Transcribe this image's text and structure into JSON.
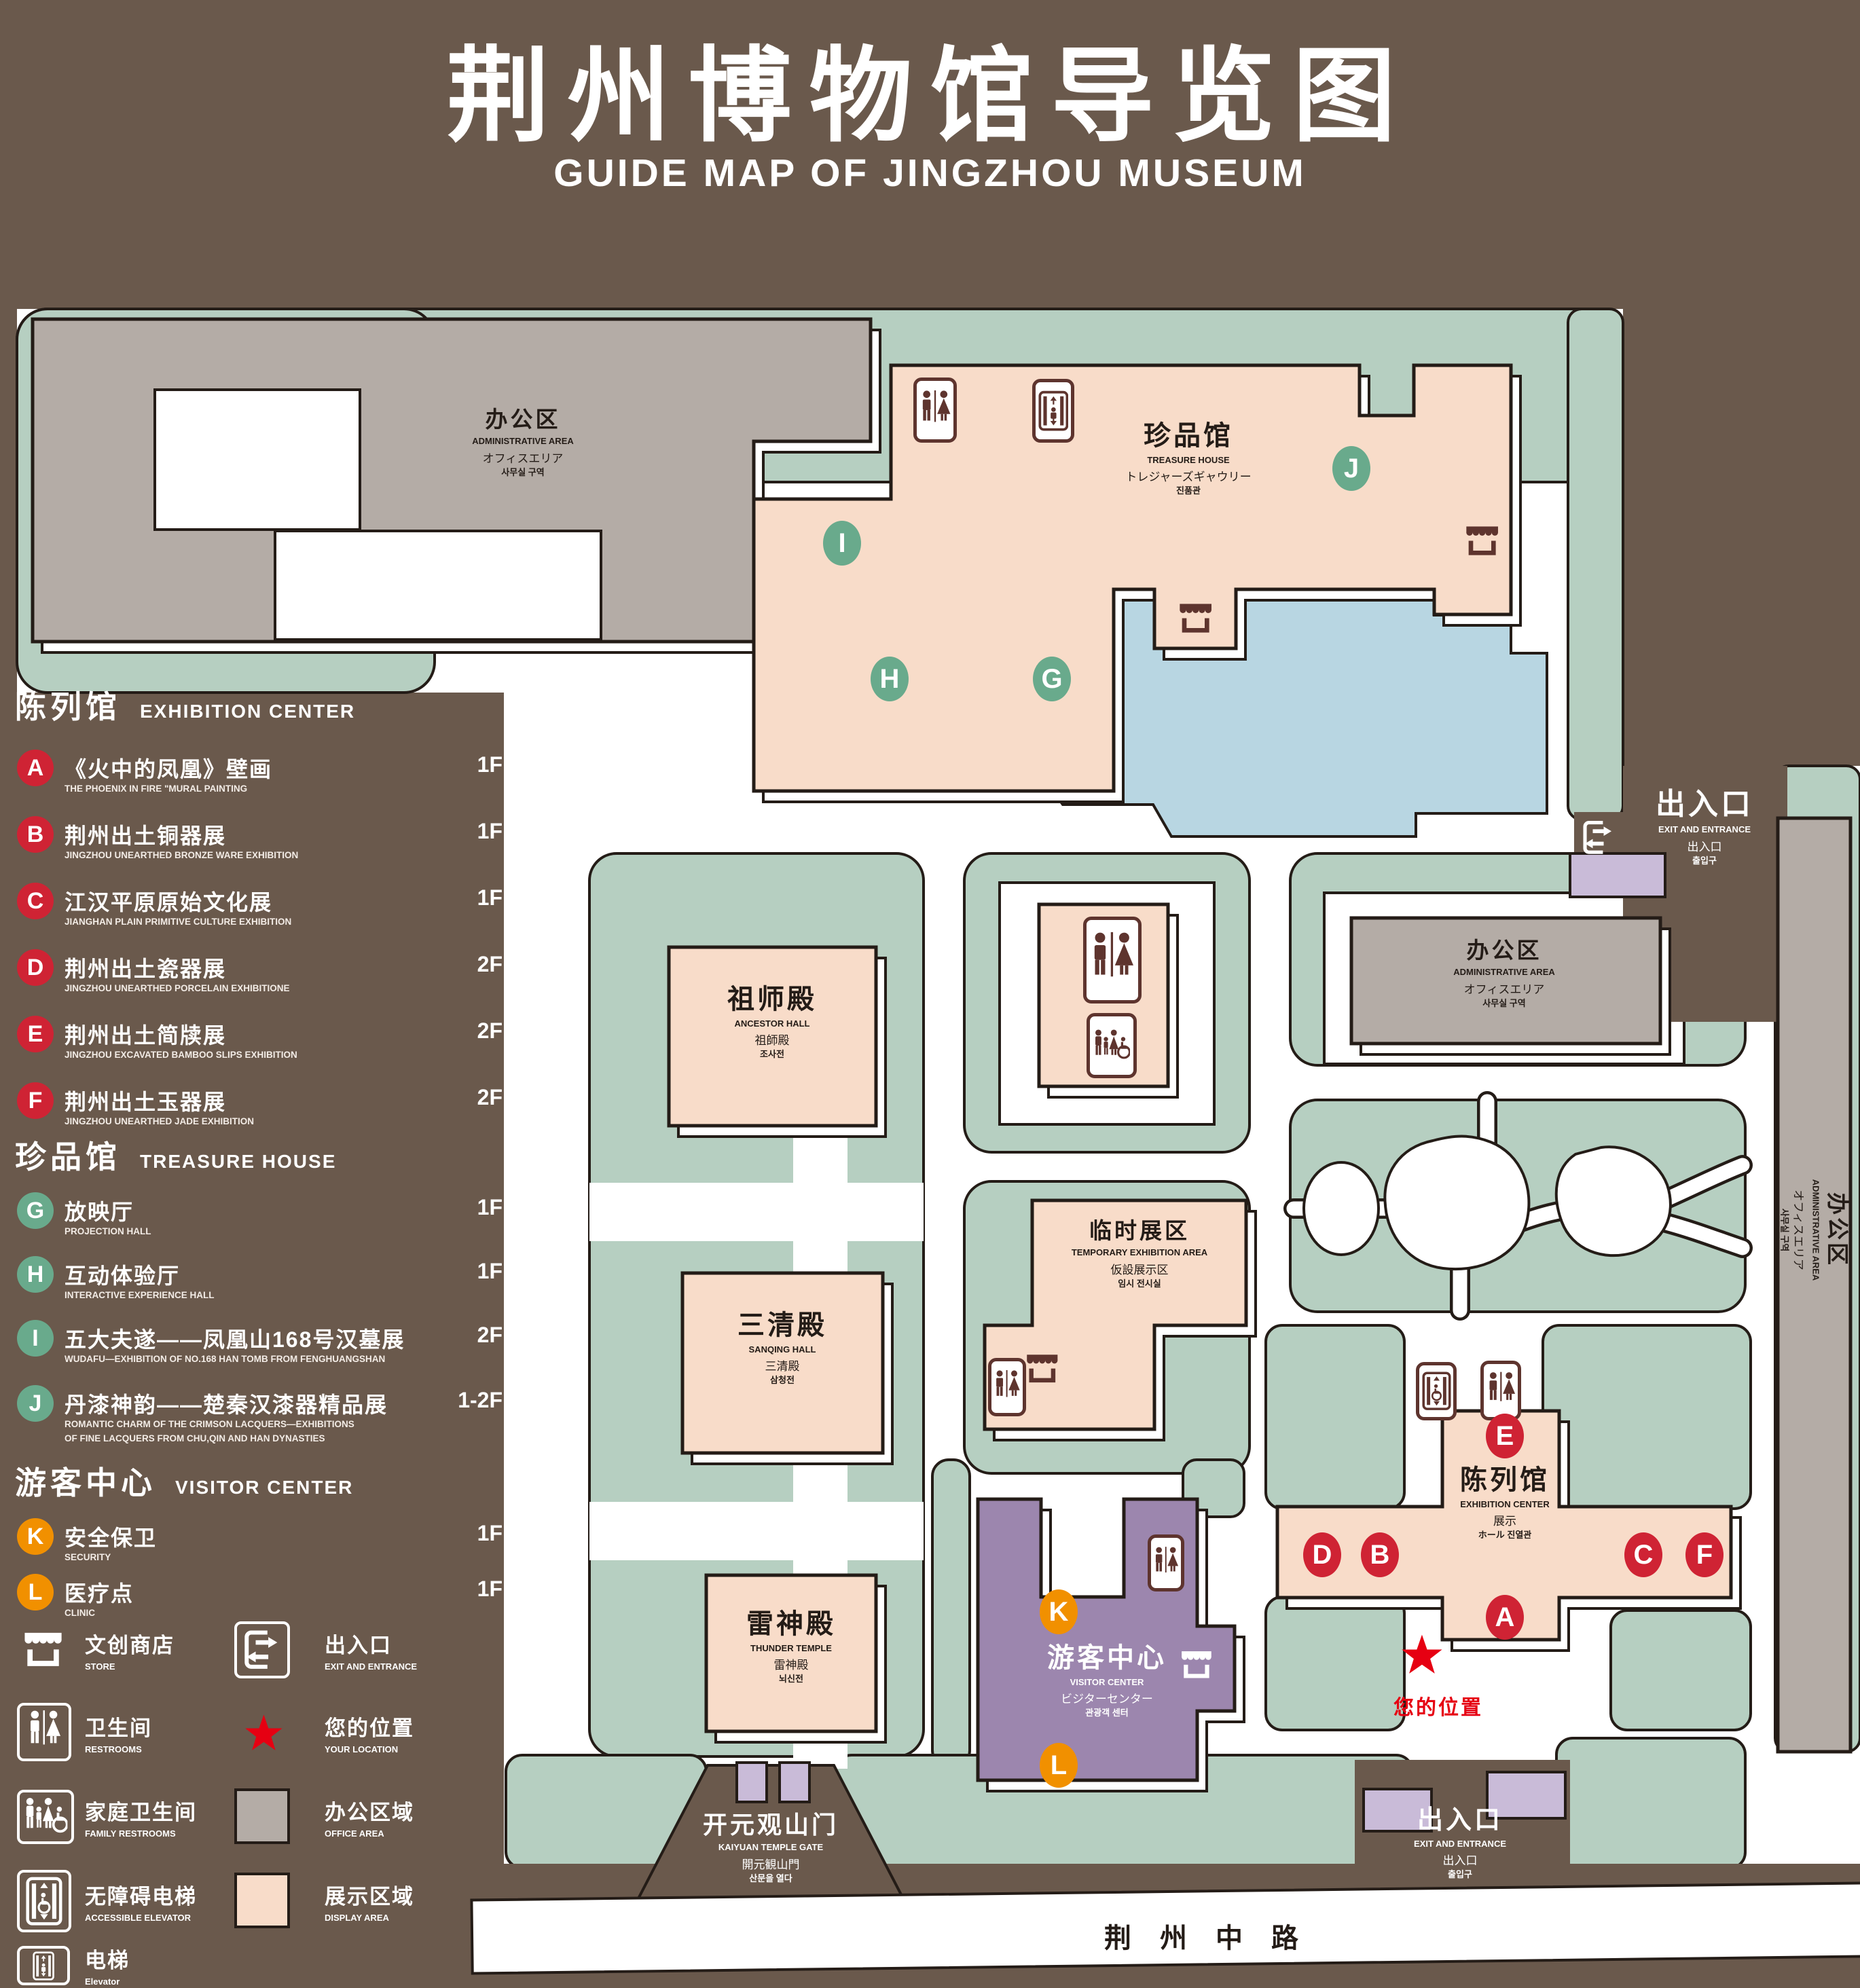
{
  "title": {
    "cn": "荆州博物馆导览图",
    "en": "GUIDE MAP OF JINGZHOU MUSEUM"
  },
  "colors": {
    "background": "#6a594c",
    "green_area": "#b6cfc1",
    "display_area": "#f8dcc9",
    "office_area": "#b4aca6",
    "visitor_center": "#9c86ae",
    "gate_purple": "#c9bbd8",
    "pond_blue": "#b8d6e2",
    "marker_red": "#cf2334",
    "marker_green": "#69aa8c",
    "marker_orange": "#f19000",
    "location_red": "#e60012",
    "icon_maroon": "#5e342e"
  },
  "legend": {
    "sections": [
      {
        "cn": "陈列馆",
        "en": "EXHIBITION CENTER",
        "items": [
          {
            "letter": "A",
            "cn": "《火中的凤凰》壁画",
            "en": "THE PHOENIX IN FIRE \"MURAL PAINTING",
            "floor": "1F"
          },
          {
            "letter": "B",
            "cn": "荆州出土铜器展",
            "en": "JINGZHOU UNEARTHED BRONZE WARE EXHIBITION",
            "floor": "1F"
          },
          {
            "letter": "C",
            "cn": "江汉平原原始文化展",
            "en": "JIANGHAN PLAIN PRIMITIVE CULTURE EXHIBITION",
            "floor": "1F"
          },
          {
            "letter": "D",
            "cn": "荆州出土瓷器展",
            "en": "JINGZHOU UNEARTHED PORCELAIN EXHIBITIONE",
            "floor": "2F"
          },
          {
            "letter": "E",
            "cn": "荆州出土简牍展",
            "en": "JINGZHOU EXCAVATED BAMBOO SLIPS EXHIBITION",
            "floor": "2F"
          },
          {
            "letter": "F",
            "cn": "荆州出土玉器展",
            "en": "JINGZHOU UNEARTHED JADE EXHIBITION",
            "floor": "2F"
          }
        ]
      },
      {
        "cn": "珍品馆",
        "en": "TREASURE HOUSE",
        "items": [
          {
            "letter": "G",
            "cn": "放映厅",
            "en": "PROJECTION HALL",
            "floor": "1F"
          },
          {
            "letter": "H",
            "cn": "互动体验厅",
            "en": "INTERACTIVE EXPERIENCE HALL",
            "floor": "1F"
          },
          {
            "letter": "I",
            "cn": "五大夫遂——凤凰山168号汉墓展",
            "en": "WUDAFU—EXHIBITION OF NO.168 HAN TOMB FROM FENGHUANGSHAN",
            "floor": "2F"
          },
          {
            "letter": "J",
            "cn": "丹漆神韵——楚秦汉漆器精品展",
            "en": "ROMANTIC CHARM OF THE CRIMSON LACQUERS—EXHIBITIONS\nOF FINE LACQUERS FROM CHU,QIN AND HAN DYNASTIES",
            "floor": "1-2F"
          }
        ]
      },
      {
        "cn": "游客中心",
        "en": "VISITOR CENTER",
        "items": [
          {
            "letter": "K",
            "cn": "安全保卫",
            "en": "SECURITY",
            "floor": "1F"
          },
          {
            "letter": "L",
            "cn": "医疗点",
            "en": "CLINIC",
            "floor": "1F"
          }
        ]
      }
    ],
    "symbols": [
      {
        "icon": "store-icon",
        "cn": "文创商店",
        "en": "STORE"
      },
      {
        "icon": "exit-icon",
        "cn": "出入口",
        "en": "EXIT AND ENTRANCE"
      },
      {
        "icon": "restrooms-icon",
        "cn": "卫生间",
        "en": "RESTROOMS"
      },
      {
        "icon": "your-location-star",
        "cn": "您的位置",
        "en": "YOUR LOCATION"
      },
      {
        "icon": "family-restrooms-icon",
        "cn": "家庭卫生间",
        "en": "FAMILY RESTROOMS"
      },
      {
        "icon": "office-area-swatch",
        "cn": "办公区域",
        "en": "OFFICE AREA"
      },
      {
        "icon": "accessible-elevator-icon",
        "cn": "无障碍电梯",
        "en": "ACCESSIBLE ELEVATOR"
      },
      {
        "icon": "display-area-swatch",
        "cn": "展示区域",
        "en": "DISPLAY AREA"
      },
      {
        "icon": "elevator-icon",
        "cn": "电梯",
        "en": "Elevator"
      }
    ]
  },
  "map": {
    "buildings": {
      "admin_top": {
        "lines": [
          "办公区",
          "ADMINISTRATIVE AREA",
          "オフィスエリア",
          "사무실 구역"
        ]
      },
      "admin_mid": {
        "lines": [
          "办公区",
          "ADMINISTRATIVE AREA",
          "オフィスエリア",
          "사무실 구역"
        ]
      },
      "admin_right": {
        "lines": [
          "办公区",
          "ADMINISTRATIVE AREA",
          "オフィスエリア",
          "사무실 구역"
        ]
      },
      "treasure_house": {
        "lines": [
          "珍品馆",
          "TREASURE HOUSE",
          "トレジャーズギャウリー",
          "진품관"
        ]
      },
      "ancestor_hall": {
        "lines": [
          "祖师殿",
          "ANCESTOR HALL",
          "祖師殿",
          "조사전"
        ]
      },
      "temporary": {
        "lines": [
          "临时展区",
          "TEMPORARY EXHIBITION AREA",
          "仮設展示区",
          "임시 전시실"
        ]
      },
      "sanqing_hall": {
        "lines": [
          "三清殿",
          "SANQING HALL",
          "三清殿",
          "삼청전"
        ]
      },
      "thunder_temple": {
        "lines": [
          "雷神殿",
          "THUNDER TEMPLE",
          "雷神殿",
          "뇌신전"
        ]
      },
      "visitor_center": {
        "lines": [
          "游客中心",
          "VISITOR CENTER",
          "ビジターセンター",
          "관광객 센터"
        ]
      },
      "exhibition_center": {
        "lines": [
          "陈列馆",
          "EXHIBITION CENTER",
          "展示",
          "ホール 진열관"
        ]
      },
      "gate": {
        "lines": [
          "开元观山门",
          "KAIYUAN TEMPLE GATE",
          "開元観山門",
          "산문을 열다"
        ]
      },
      "exit_right": {
        "lines": [
          "出入口",
          "EXIT AND ENTRANCE",
          "出入口",
          "출입구"
        ]
      },
      "exit_bottom": {
        "lines": [
          "出入口",
          "EXIT AND ENTRANCE",
          "出入口",
          "출입구"
        ]
      }
    },
    "road": {
      "cn": "荆州中路"
    },
    "your_location": {
      "cn": "您的位置"
    },
    "marker_letters": {
      "A": "A",
      "B": "B",
      "C": "C",
      "D": "D",
      "E": "E",
      "F": "F",
      "G": "G",
      "H": "H",
      "I": "I",
      "J": "J",
      "K": "K",
      "L": "L"
    }
  }
}
